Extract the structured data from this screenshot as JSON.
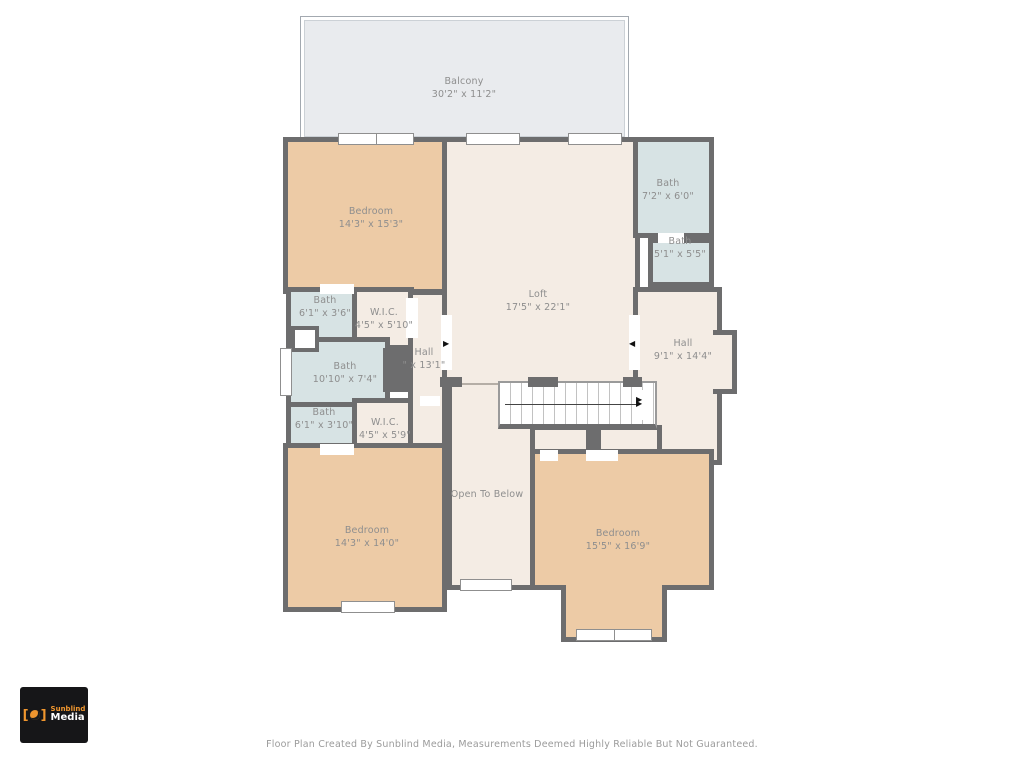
{
  "page": {
    "footer": "Floor Plan Created By Sunblind Media, Measurements Deemed Highly Reliable But Not Guaranteed."
  },
  "logo": {
    "brand_top": "Sunblind",
    "brand_bottom": "Media",
    "icon": "sunblind-swirl-icon",
    "accent_color": "#f0962e",
    "background_color": "#161618"
  },
  "colors": {
    "wall": "#6d6d6e",
    "bedroom_fill": "#edcba6",
    "bath_fill": "#d7e3e4",
    "hall_fill": "#f4ece4",
    "balcony_fill": "#e9ebee",
    "label_text": "#8e8e8e"
  },
  "rooms": [
    {
      "name": "Balcony",
      "dims": "30'2\" x 11'2\""
    },
    {
      "name": "Bedroom",
      "dims": "14'3\" x 15'3\""
    },
    {
      "name": "Bath",
      "dims": "7'2\" x 6'0\""
    },
    {
      "name": "Bath",
      "dims": "5'1\" x 5'5\""
    },
    {
      "name": "Loft",
      "dims": "17'5\" x 22'1\""
    },
    {
      "name": "Hall",
      "dims": "9'1\" x 14'4\""
    },
    {
      "name": "Bath",
      "dims": "6'1\" x 3'6\""
    },
    {
      "name": "W.I.C.",
      "dims": "4'5\" x 5'10\""
    },
    {
      "name": "Bath",
      "dims": "10'10\" x 7'4\""
    },
    {
      "name": "Hall",
      "dims": "\" x 13'1\""
    },
    {
      "name": "Bath",
      "dims": "6'1\" x 3'10\""
    },
    {
      "name": "W.I.C.",
      "dims": "4'5\" x 5'9\""
    },
    {
      "name": "Bedroom",
      "dims": "14'3\" x 14'0\""
    },
    {
      "name": "Open To Below",
      "dims": ""
    },
    {
      "name": "Bedroom",
      "dims": "15'5\" x 16'9\""
    }
  ]
}
